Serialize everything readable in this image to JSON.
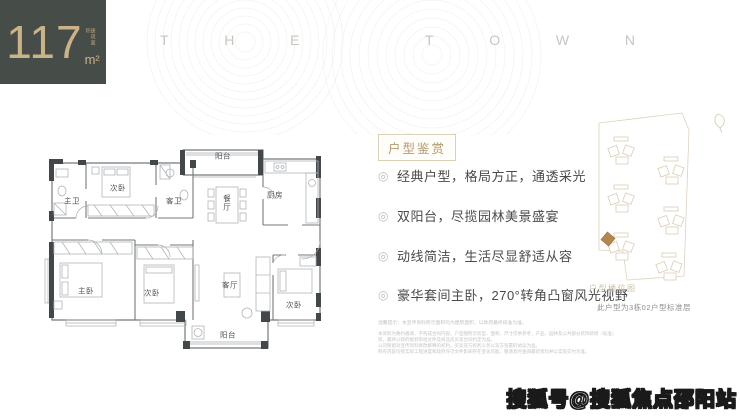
{
  "area": {
    "value": "117",
    "unit": "m²",
    "label": "建筑面积"
  },
  "brand": {
    "text": "THE TOWN",
    "letters": [
      "T",
      "H",
      "E",
      "T",
      "O",
      "W",
      "N"
    ]
  },
  "floor_plan": {
    "rooms": [
      {
        "label": "阳台"
      },
      {
        "label": "次卧"
      },
      {
        "label": "主卫"
      },
      {
        "label": "客卫"
      },
      {
        "label": "餐厅"
      },
      {
        "label": "厨房"
      },
      {
        "label": "主卧"
      },
      {
        "label": "次卧"
      },
      {
        "label": "客厅"
      },
      {
        "label": "次卧"
      },
      {
        "label": "阳台"
      }
    ]
  },
  "details": {
    "title": "户型鉴赏",
    "bullet_icon": "◎",
    "bullets": [
      "经典户型，格局方正，通透采光",
      "双阳台，尽揽园林美景盛宴",
      "动线简洁，生活尽显舒适从容",
      "豪华套间主卧，270°转角凸窗风光视野"
    ]
  },
  "site_map": {
    "caption": "户型楼位图",
    "note": "此户型为3栋02户型标准层"
  },
  "disclaimer": {
    "line1": "温馨提示：本宣传资料所示面积均为建筑面积，以政府最终核准为准。",
    "para1": "本资料为要约邀请，不构成合同内容。户型图所示房型、面积、尺寸仅供参考，产品、园林及公共部分装饰装修（标准）等，最终以政府规划审批文件及商品房买卖合同约定为准。",
    "para2": "公司保留对宣传资料修改解释的权利，买卖双方权利义务以双方签署的协议为准。",
    "para3": "所有内容均受实际工程进度和政府许可文件影响存在变化可能，敬请及时查阅最新资料并以实际交付为准。"
  },
  "watermark": "搜狐号@搜狐焦点邵阳站",
  "colors": {
    "panel_dark": "#464c48",
    "accent_gold": "#cbb387",
    "title_gold": "#b49a6e",
    "border_gold": "#dbcfb5",
    "site_tan": "#d9cdb4",
    "site_highlight": "#b5854f",
    "text_dark": "#4a4a4a",
    "wall_dark": "#42474a"
  }
}
